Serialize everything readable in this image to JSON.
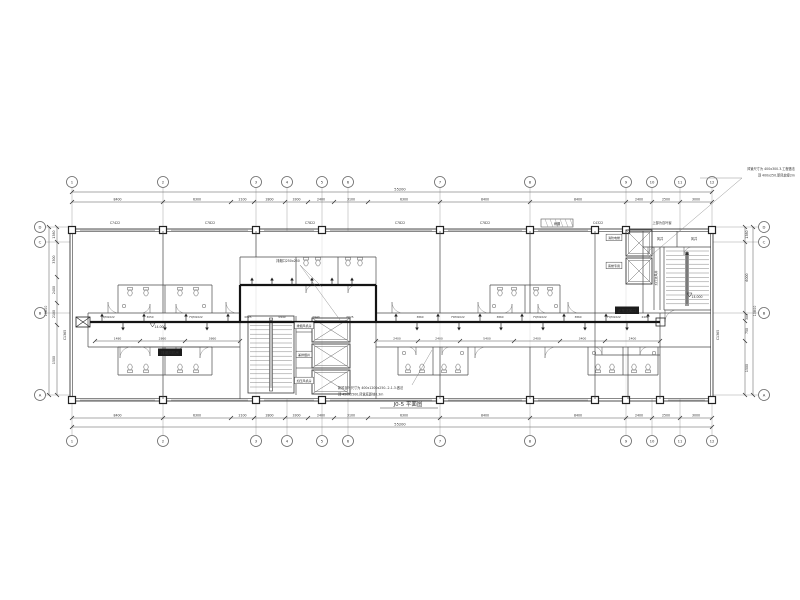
{
  "sheet": {
    "title": "J0-5 平面图"
  },
  "colors": {
    "line": "#4a4a4a",
    "bold_duct": "#141414",
    "grid_stem": "#9a9a9a",
    "text": "#2b2b2b",
    "dark_label_bg": "#1c1c1c",
    "dark_label_fg": "#ffffff"
  },
  "overall_dims": {
    "top": "55200",
    "bottom": "55200",
    "left": "10800",
    "right": "10800"
  },
  "grid": {
    "top": {
      "y": 182,
      "bubbles": [
        {
          "x": 72,
          "t": "1"
        },
        {
          "x": 163,
          "t": "2"
        },
        {
          "x": 256,
          "t": "3"
        },
        {
          "x": 287,
          "t": "4"
        },
        {
          "x": 322,
          "t": "5"
        },
        {
          "x": 348,
          "t": "6"
        },
        {
          "x": 440,
          "t": "7"
        },
        {
          "x": 530,
          "t": "8"
        },
        {
          "x": 626,
          "t": "9"
        },
        {
          "x": 652,
          "t": "10"
        },
        {
          "x": 680,
          "t": "11"
        },
        {
          "x": 712,
          "t": "12"
        }
      ]
    },
    "bottom": {
      "y": 441,
      "bubbles": [
        {
          "x": 72,
          "t": "1"
        },
        {
          "x": 163,
          "t": "2"
        },
        {
          "x": 256,
          "t": "3"
        },
        {
          "x": 287,
          "t": "4"
        },
        {
          "x": 322,
          "t": "5"
        },
        {
          "x": 348,
          "t": "6"
        },
        {
          "x": 440,
          "t": "7"
        },
        {
          "x": 530,
          "t": "8"
        },
        {
          "x": 626,
          "t": "9"
        },
        {
          "x": 652,
          "t": "10"
        },
        {
          "x": 680,
          "t": "11"
        },
        {
          "x": 712,
          "t": "12"
        }
      ]
    },
    "left": {
      "x": 40,
      "bubbles": [
        {
          "y": 227,
          "t": "D"
        },
        {
          "y": 242,
          "t": "C"
        },
        {
          "y": 313,
          "t": "B"
        },
        {
          "y": 395,
          "t": "A"
        }
      ]
    },
    "right": {
      "x": 764,
      "bubbles": [
        {
          "y": 227,
          "t": "D"
        },
        {
          "y": 242,
          "t": "C"
        },
        {
          "y": 313,
          "t": "B"
        },
        {
          "y": 395,
          "t": "A"
        }
      ]
    }
  },
  "dim_rows": {
    "top": {
      "y": 202,
      "ticks": [
        72,
        163,
        231,
        254,
        285,
        308,
        334,
        368,
        440,
        530,
        626,
        652,
        680,
        712
      ],
      "values": [
        "8400",
        "6300",
        "2100",
        "2800",
        "3300",
        "2400",
        "3100",
        "6300",
        "8400",
        "8400",
        "2400",
        "2500",
        "3000"
      ]
    },
    "bottom": {
      "y": 418,
      "ticks": [
        72,
        163,
        231,
        254,
        285,
        308,
        334,
        368,
        440,
        530,
        626,
        652,
        680,
        712
      ],
      "values": [
        "8400",
        "6300",
        "2100",
        "2800",
        "3300",
        "2400",
        "3100",
        "6300",
        "8400",
        "8400",
        "2400",
        "2500",
        "3000"
      ]
    },
    "left": {
      "x": 57,
      "ticks": [
        227,
        242,
        277,
        303,
        325,
        395
      ],
      "values": [
        "1380",
        "3300",
        "2400",
        "2100",
        "1500"
      ]
    },
    "right": {
      "x": 745,
      "ticks": [
        227,
        242,
        313,
        321,
        341,
        395
      ],
      "values": [
        "1380",
        "6000",
        "300",
        "750",
        "1500"
      ]
    }
  },
  "corridor_rows": {
    "codes": {
      "y": 318,
      "items": [
        {
          "x": 108,
          "t": "FQM1022"
        },
        {
          "x": 150,
          "t": "3050"
        },
        {
          "x": 196,
          "t": "FQM1022"
        },
        {
          "x": 248,
          "t": "0625"
        },
        {
          "x": 282,
          "t": "0940"
        },
        {
          "x": 316,
          "t": "0940"
        },
        {
          "x": 350,
          "t": "0625"
        },
        {
          "x": 420,
          "t": "3860"
        },
        {
          "x": 458,
          "t": "FDM1022"
        },
        {
          "x": 500,
          "t": "3860"
        },
        {
          "x": 540,
          "t": "FQM1022"
        },
        {
          "x": 578,
          "t": "3860"
        },
        {
          "x": 614,
          "t": "FQM1022"
        },
        {
          "x": 645,
          "t": "2400"
        }
      ]
    },
    "dims": {
      "y": 341,
      "ticks": [
        95,
        140,
        185,
        240,
        376,
        418,
        460,
        514,
        560,
        605,
        660
      ],
      "values": [
        "1480",
        "2860",
        "3860",
        "",
        "2400",
        "2400",
        "5400",
        "2400",
        "3400",
        "2400"
      ]
    }
  },
  "window_codes": {
    "y": 224,
    "items": [
      {
        "x": 115,
        "t": "C7422"
      },
      {
        "x": 210,
        "t": "C7822"
      },
      {
        "x": 310,
        "t": "C7822"
      },
      {
        "x": 400,
        "t": "C7822"
      },
      {
        "x": 485,
        "t": "C7822"
      },
      {
        "x": 598,
        "t": "C4322"
      }
    ]
  },
  "vertical_codes": [
    {
      "x": 66,
      "y": 335,
      "t": "C1365"
    },
    {
      "x": 719,
      "y": 335,
      "t": "C1365"
    }
  ],
  "labels": [
    {
      "x": 170,
      "y": 354,
      "t": "排烟风机房",
      "style": "dark"
    },
    {
      "x": 627,
      "y": 312,
      "t": "正压送风口",
      "style": "dark"
    },
    {
      "x": 304,
      "y": 327,
      "t": "排烟风机房",
      "style": "box"
    },
    {
      "x": 304,
      "y": 356,
      "t": "兼排烟井",
      "style": "box"
    },
    {
      "x": 304,
      "y": 382,
      "t": "加压风机房",
      "style": "box"
    },
    {
      "x": 614,
      "y": 239,
      "t": "消防电梯",
      "style": "box"
    },
    {
      "x": 614,
      "y": 267,
      "t": "客梯专用",
      "style": "box"
    },
    {
      "x": 660,
      "y": 240,
      "t": "风井",
      "style": "plain"
    },
    {
      "x": 694,
      "y": 240,
      "t": "风井",
      "style": "plain"
    },
    {
      "x": 662,
      "y": 224,
      "t": "上部为百叶窗",
      "style": "plain"
    },
    {
      "x": 557,
      "y": 225,
      "t": "雨棚",
      "style": "plain"
    },
    {
      "x": 288,
      "y": 262,
      "t": "排烟口250x250",
      "style": "plain"
    },
    {
      "x": 160,
      "y": 328,
      "t": "14.000",
      "style": "plain"
    },
    {
      "x": 697,
      "y": 298,
      "t": "14.000",
      "style": "plain"
    },
    {
      "x": 657,
      "y": 278,
      "t": "加压送风井",
      "style": "vert"
    }
  ],
  "annotations": {
    "top_right": {
      "x": 795,
      "y": 170,
      "lines": [
        "风管尺寸为 400x300.3.工程做法",
        "顶 400x250.新风软接2m"
      ]
    },
    "bottom_center": {
      "x": 338,
      "y": 389,
      "lines": [
        "新风百叶尺寸为 400x1200x250.-2-1.3.做法",
        "顶 450x2500.风管底距地0.3m"
      ]
    }
  },
  "title_pos": {
    "x": 408,
    "y": 406
  }
}
